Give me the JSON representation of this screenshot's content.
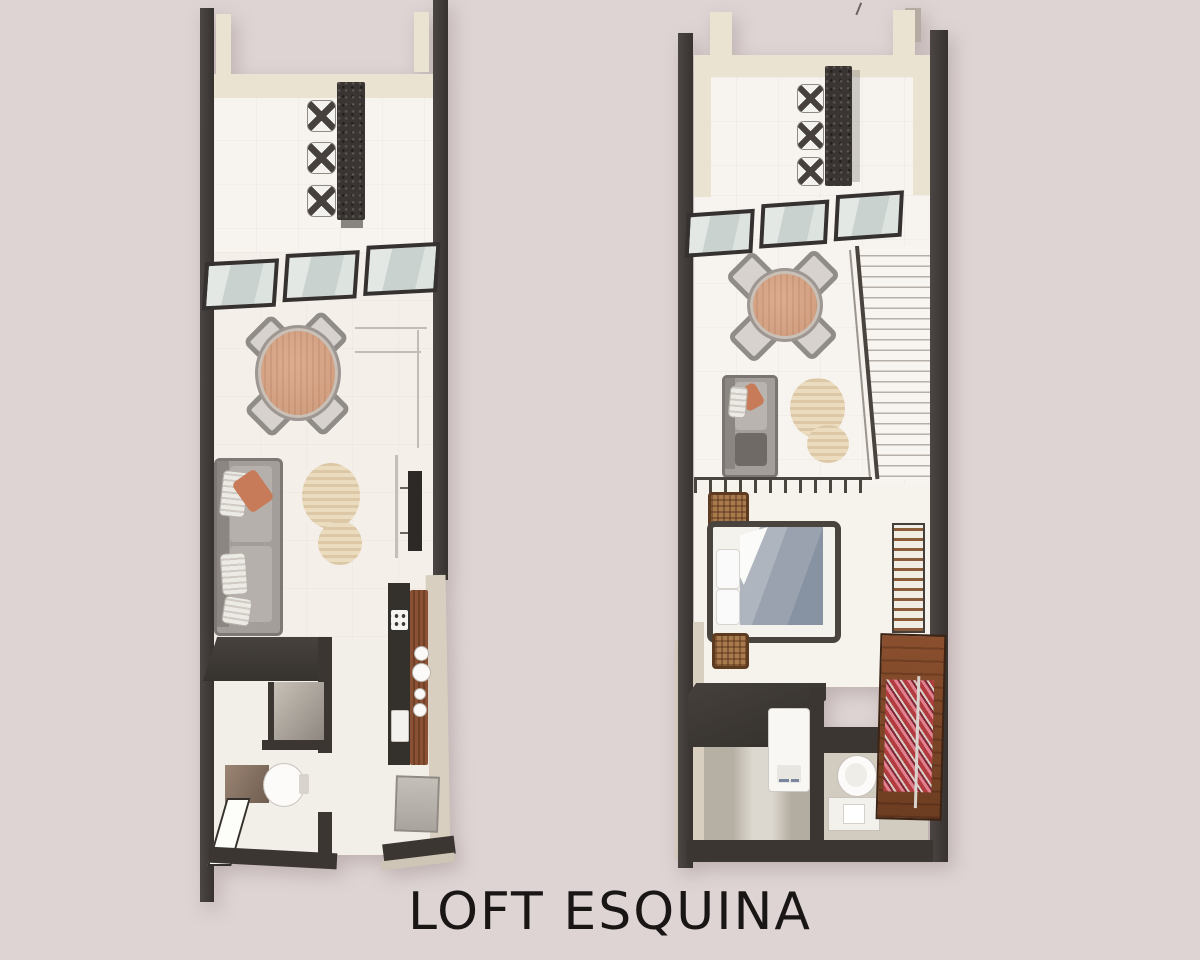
{
  "title": "LOFT ESQUINA",
  "colors": {
    "background": "#ded4d4",
    "wall_dark": "#3b3632",
    "wall_top_cream": "#ebe3d2",
    "floor": "#f7f3ee",
    "table_wood": "#d5a485",
    "sofa_grey": "#a49f9a",
    "accent_terracotta": "#c87b59",
    "rug_beige": "#ecdcbf",
    "window_glass": "#ccd4d0",
    "bed_blanket": "#99a2ae",
    "closet_wood": "#7c4628",
    "clothes_pink": "#e2808f",
    "title_text": "#1a1616"
  },
  "plans": {
    "left": {
      "id": "plan-left",
      "rooms": [
        "kitchen-bar",
        "dining-living",
        "hallway",
        "bathroom",
        "galley-kitchen"
      ],
      "furniture": [
        "breakfast-bar",
        "bar-stools-x3",
        "window-row-x3",
        "round-dining-table",
        "dining-chairs-x4",
        "sofa",
        "area-rug",
        "tv",
        "closet-platform",
        "shower-glass",
        "vanity",
        "toilet",
        "shower-door",
        "kitchen-counter",
        "stove",
        "sink-plates",
        "fridge"
      ]
    },
    "right": {
      "id": "plan-right",
      "rooms": [
        "kitchen-bar",
        "dining-living",
        "staircase",
        "bedroom",
        "bathroom",
        "closet"
      ],
      "furniture": [
        "breakfast-bar",
        "bar-stools-x3",
        "window-row-x3",
        "round-dining-table",
        "dining-chairs-x4",
        "sofa",
        "area-rug",
        "staircase",
        "double-bed",
        "basket-x2",
        "clothes-rack",
        "desk",
        "shower-unit",
        "toilet",
        "vanity",
        "wardrobe-with-clothes"
      ]
    }
  }
}
